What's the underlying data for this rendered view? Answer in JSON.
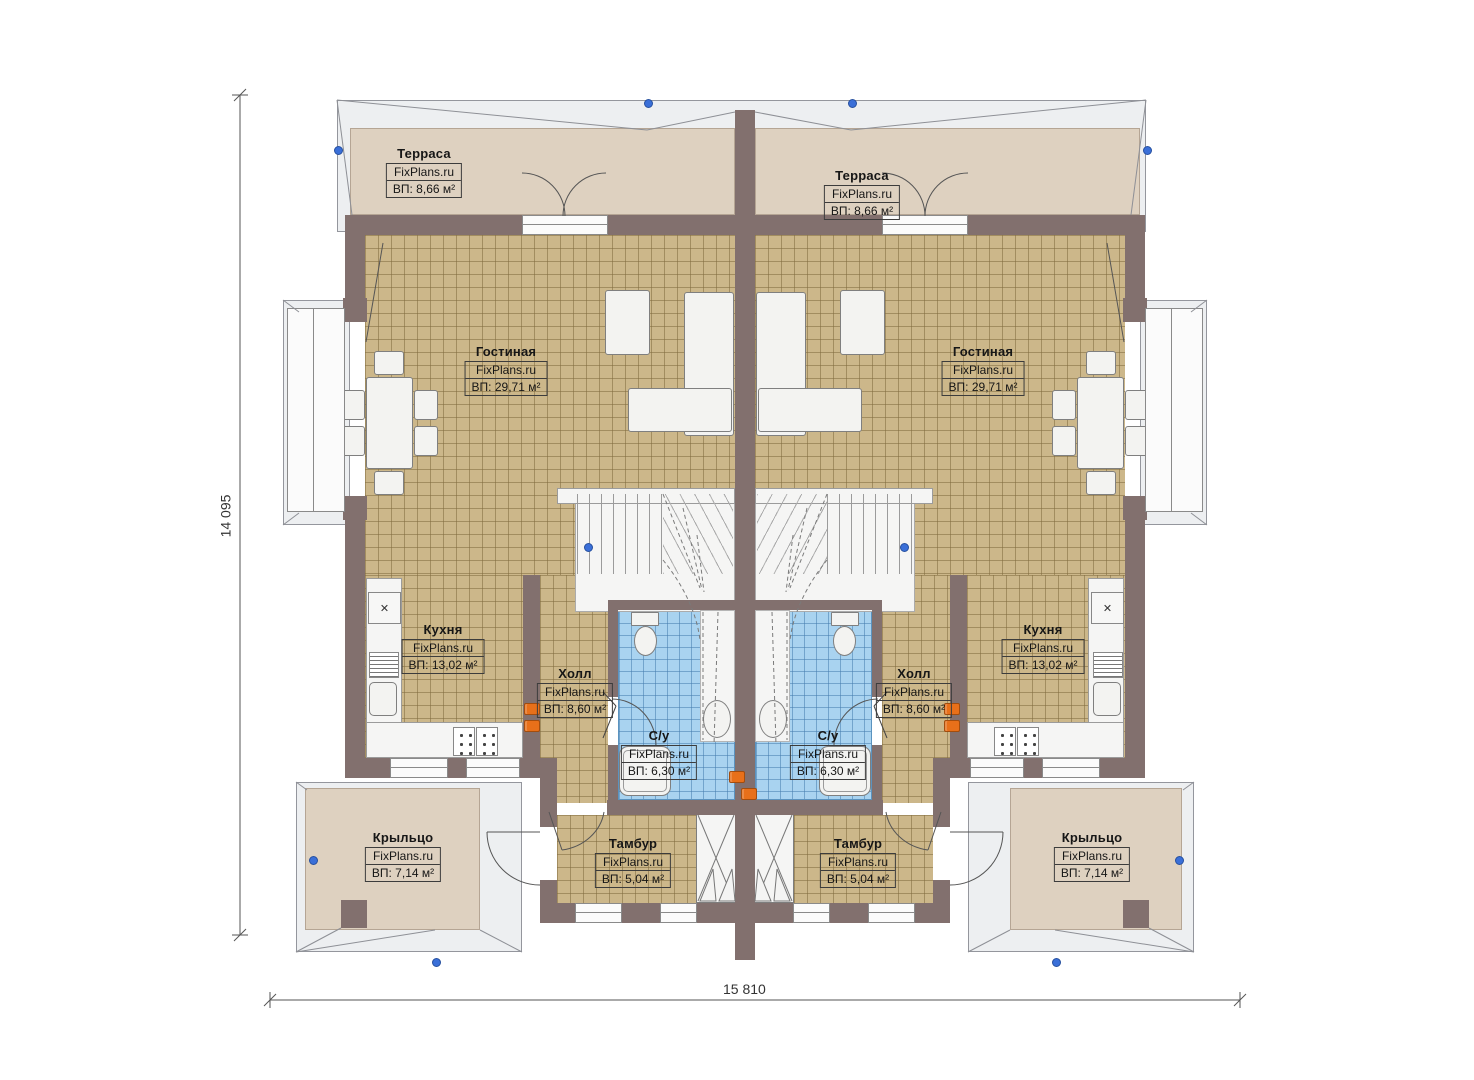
{
  "plan": {
    "title": "Duplex ground floor plan",
    "watermark": "FixPlans.ru",
    "rooms": {
      "terrace": {
        "name": "Терраса",
        "area": "ВП: 8,66 м²"
      },
      "living": {
        "name": "Гостиная",
        "area": "ВП: 29,71 м²"
      },
      "kitchen": {
        "name": "Кухня",
        "area": "ВП: 13,02 м²"
      },
      "hall": {
        "name": "Холл",
        "area": "ВП: 8,60 м²"
      },
      "wc": {
        "name": "С/у",
        "area": "ВП: 6,30 м²"
      },
      "vestibule": {
        "name": "Тамбур",
        "area": "ВП: 5,04 м²"
      },
      "porch": {
        "name": "Крыльцо",
        "area": "ВП: 7,14 м²"
      }
    },
    "dimensions": {
      "width_label": "15 810",
      "height_label": "14 095"
    },
    "icons": {
      "fridge_x": "✕"
    },
    "colors": {
      "wall": "#82706e",
      "tile_tan": "#ccb78a",
      "tile_blue": "#a9d3f0",
      "terrace": "#ded1c0",
      "roof": "#edeff1",
      "outlet": "#e8701a",
      "node": "#3a6fd8"
    }
  }
}
